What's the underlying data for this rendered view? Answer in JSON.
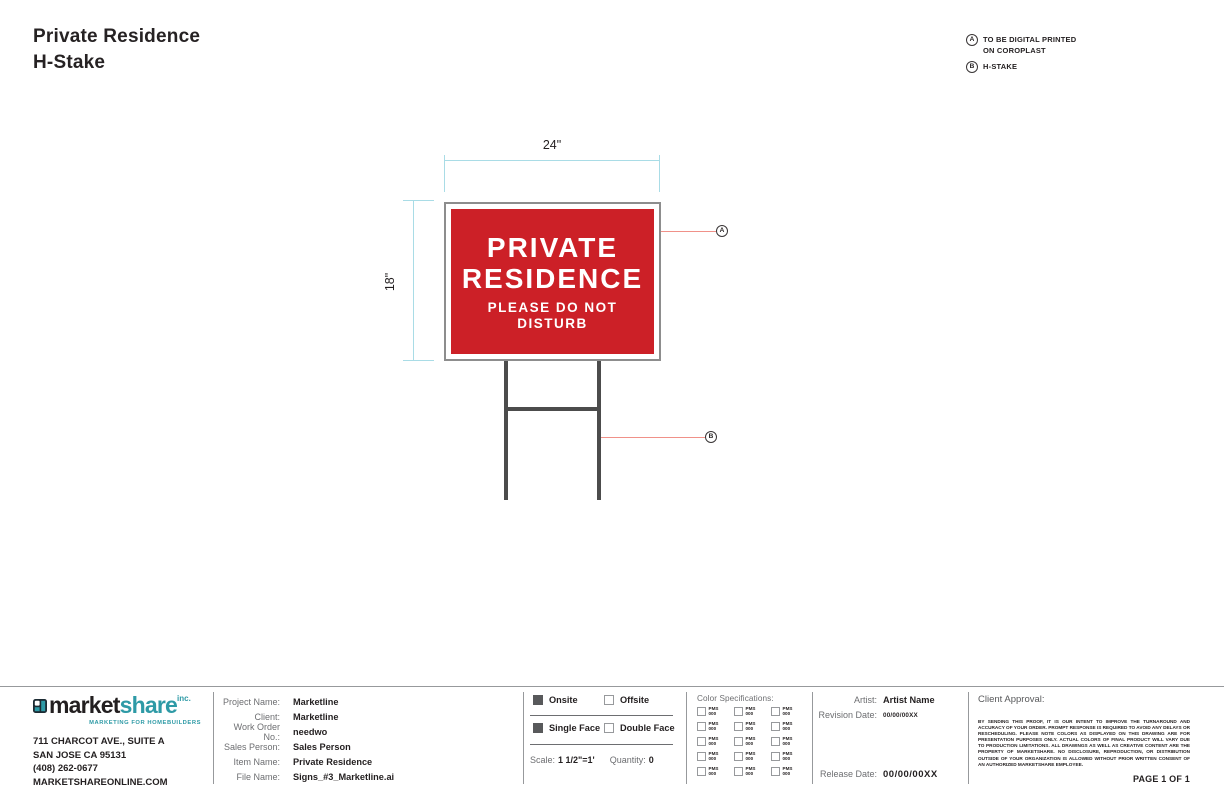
{
  "title": {
    "line1": "Private Residence",
    "line2": "H-Stake"
  },
  "legend": {
    "a_marker": "A",
    "a_line1": "TO BE DIGITAL PRINTED",
    "a_line2": "ON COROPLAST",
    "b_marker": "B",
    "b_label": "H-STAKE"
  },
  "drawing": {
    "width_label": "24\"",
    "height_label": "18\"",
    "callout_a": "A",
    "callout_b": "B",
    "sign": {
      "line1": "PRIVATE",
      "line2": "RESIDENCE",
      "line3": "PLEASE DO NOT",
      "line4": "DISTURB"
    }
  },
  "footer": {
    "logo": {
      "word1": "market",
      "word2": "share",
      "suffix": "inc.",
      "tagline": "MARKETING FOR HOMEBUILDERS"
    },
    "address": {
      "line1": "711 CHARCOT AVE., SUITE A",
      "line2": "SAN JOSE CA 95131",
      "line3": "(408) 262-0677",
      "line4": "MARKETSHAREONLINE.COM"
    },
    "project": {
      "rows": [
        {
          "label": "Project Name:",
          "value": "Marketline"
        },
        {
          "label": "Client:",
          "value": "Marketline"
        },
        {
          "label": "Work Order No.:",
          "value": "needwo"
        },
        {
          "label": "Sales Person:",
          "value": "Sales Person"
        },
        {
          "label": "Item Name:",
          "value": "Private Residence"
        },
        {
          "label": "File Name:",
          "value": "Signs_#3_Marketline.ai"
        }
      ]
    },
    "options": {
      "onsite": {
        "label": "Onsite",
        "checked": true
      },
      "offsite": {
        "label": "Offsite",
        "checked": false
      },
      "single_face": {
        "label": "Single Face",
        "checked": true
      },
      "double_face": {
        "label": "Double Face",
        "checked": false
      },
      "scale_label": "Scale:",
      "scale_value": "1 1/2\"=1'",
      "quantity_label": "Quantity:",
      "quantity_value": "0"
    },
    "color_specs": {
      "heading": "Color Specifications:",
      "cell_line1": "PMS",
      "cell_line2": "000",
      "rows": 5,
      "cols": 3
    },
    "artist": {
      "artist_label": "Artist:",
      "artist_value": "Artist Name",
      "revision_label": "Revision Date:",
      "revision_value": "00/00/00XX",
      "release_label": "Release Date:",
      "release_value": "00/00/00XX"
    },
    "approval": {
      "heading": "Client Approval:",
      "legal": "BY SENDING THIS PROOF, IT IS OUR INTENT TO IMPROVE THE TURNAROUND AND ACCURACY OF YOUR ORDER. PROMPT RESPONSE IS REQUIRED TO AVOID ANY DELAYS OR RESCHEDULING. PLEASE NOTE COLORS AS DISPLAYED ON THIS DRAWING ARE FOR PRESENTATION PURPOSES ONLY. ACTUAL COLORS OF FINAL PRODUCT WILL VARY DUE TO PRODUCTION LIMITATIONS. ALL DRAWINGS AS WELL AS CREATIVE CONTENT ARE THE PROPERTY OF MARKETSHARE. NO DISCLOSURE, REPRODUCTION, OR DISTRIBUTION OUTSIDE OF YOUR ORGANIZATION IS ALLOWED WITHOUT PRIOR WRITTEN CONSENT OF AN AUTHORIZED MARKETSHARE EMPLOYEE.",
      "page": "PAGE 1 OF 1"
    }
  },
  "colors": {
    "sign_red": "#cc2027",
    "dimension_cyan": "#a9dce6",
    "leader_red": "#f09189",
    "stake_gray": "#4c4c4c",
    "brand_teal": "#2e9aa6",
    "checkbox_fill": "#58595b"
  }
}
